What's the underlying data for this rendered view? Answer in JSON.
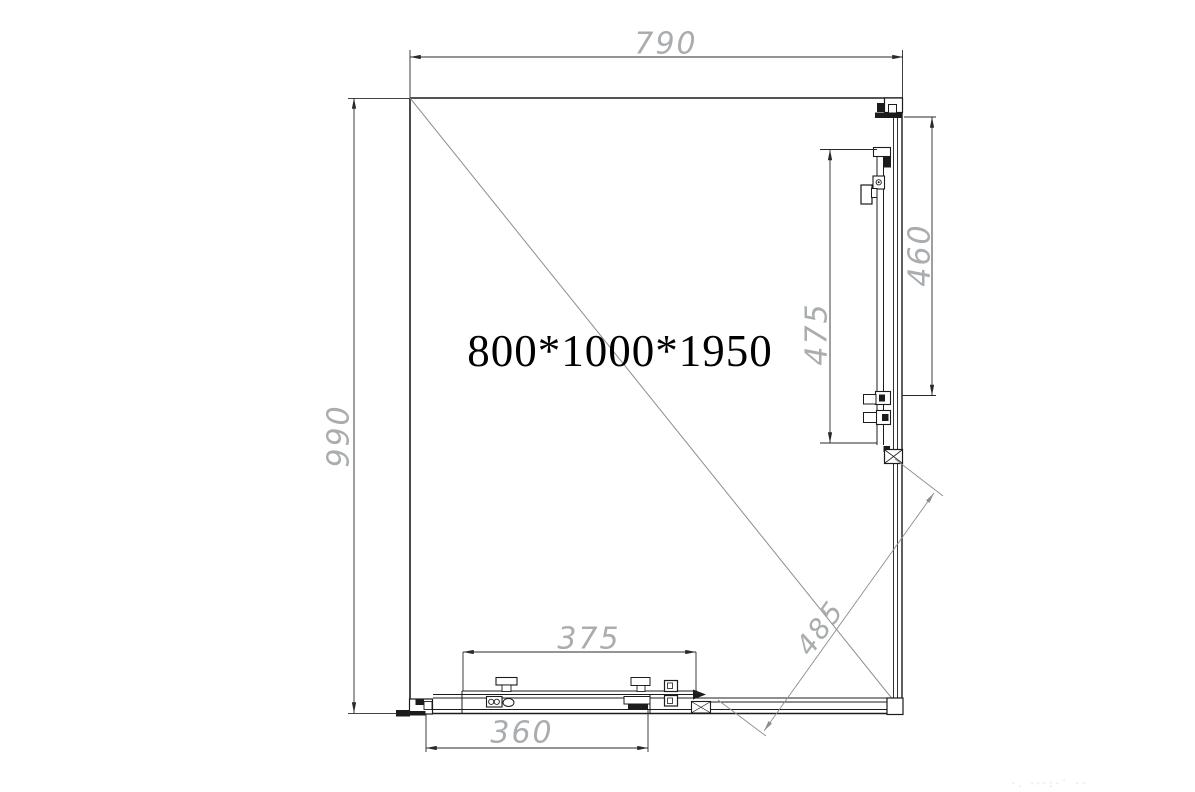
{
  "drawing": {
    "product_label": "800*1000*1950",
    "dimensions": {
      "top_width": "790",
      "left_height": "990",
      "right_panel": "460",
      "right_door": "475",
      "bottom_panel_top": "375",
      "bottom_door": "360",
      "diagonal_opening": "485"
    },
    "watermark": "·. ···:·˙   ··"
  },
  "colors": {
    "line": "#1c1c1c",
    "dim_line": "#2a2a2a",
    "dim_text": "#aaadaf",
    "diagonal": "#8d8d8d",
    "background": "#ffffff",
    "label_text": "#000000"
  }
}
